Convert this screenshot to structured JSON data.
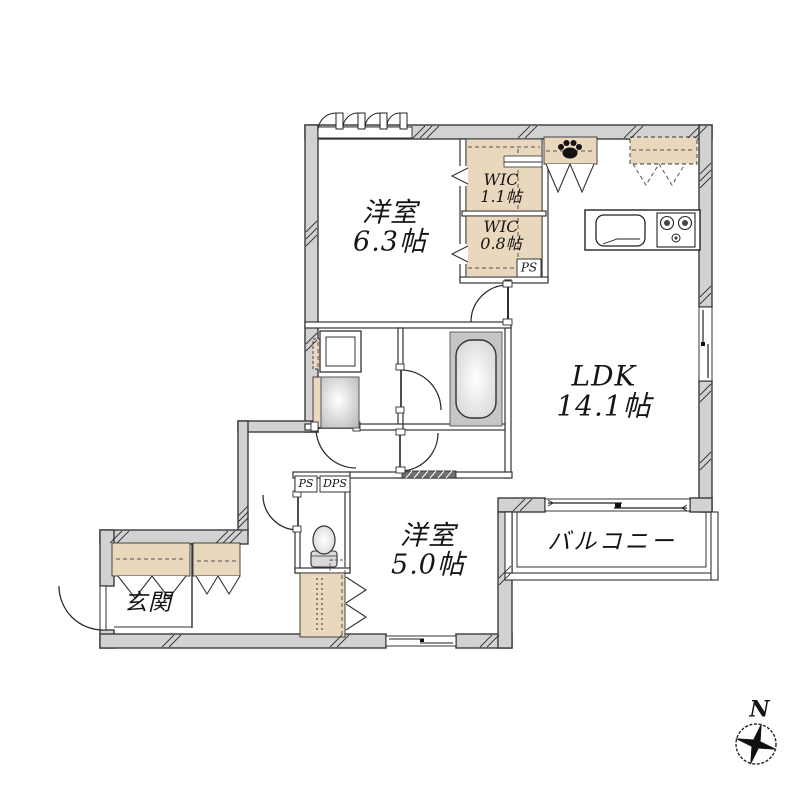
{
  "rooms": {
    "bedroom1": {
      "name": "洋室",
      "size": "6.3帖"
    },
    "wic_upper": {
      "name": "WIC",
      "size": "1.1帖"
    },
    "wic_lower": {
      "name": "WIC",
      "size": "0.8帖"
    },
    "ldk": {
      "name": "LDK",
      "size": "14.1帖"
    },
    "bedroom2": {
      "name": "洋室",
      "size": "5.0帖"
    },
    "balcony": {
      "name": "バルコニー"
    },
    "entrance": {
      "name": "玄関"
    }
  },
  "labels": {
    "ps_wic": "PS",
    "ps_hall": "PS",
    "dps_hall": "DPS",
    "compass_north": "N"
  },
  "colors": {
    "wall_fill": "#d2d2d2",
    "closet_fill": "#e9d8bd",
    "fixture_gray": "#c6c6c6",
    "line": "#2f2f2f"
  }
}
